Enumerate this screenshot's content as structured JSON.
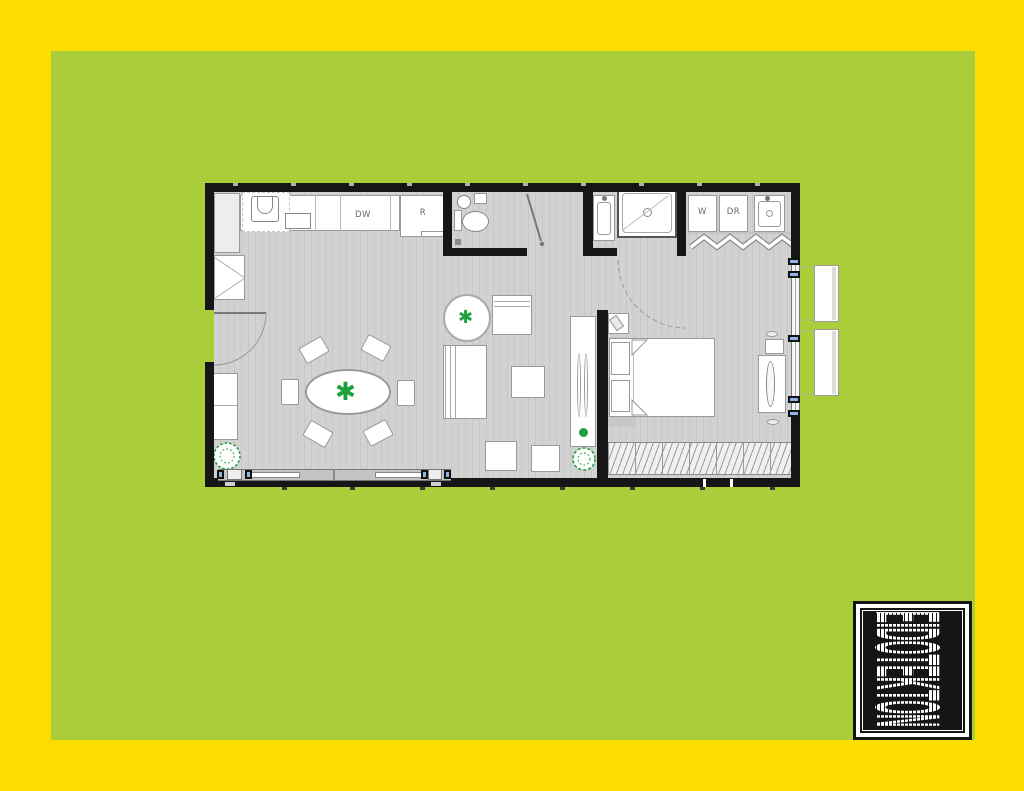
{
  "colors": {
    "yellow": "#FBDE00",
    "green": "#A9CE39",
    "wall": "#161616",
    "floor": "#D2D2D2",
    "plank": "#C7C7C7",
    "line": "#999999",
    "plant": "#1FA03C",
    "blue": "#8FB3E8",
    "ink": "#151515"
  },
  "plan": {
    "appliance_labels": {
      "dishwasher": "DW",
      "refrigerator": "R",
      "washer": "W",
      "dryer": "DR"
    },
    "icons": {
      "plant_glyph": "✱"
    }
  },
  "logo": {
    "brand": "EIDOTEKTON"
  }
}
